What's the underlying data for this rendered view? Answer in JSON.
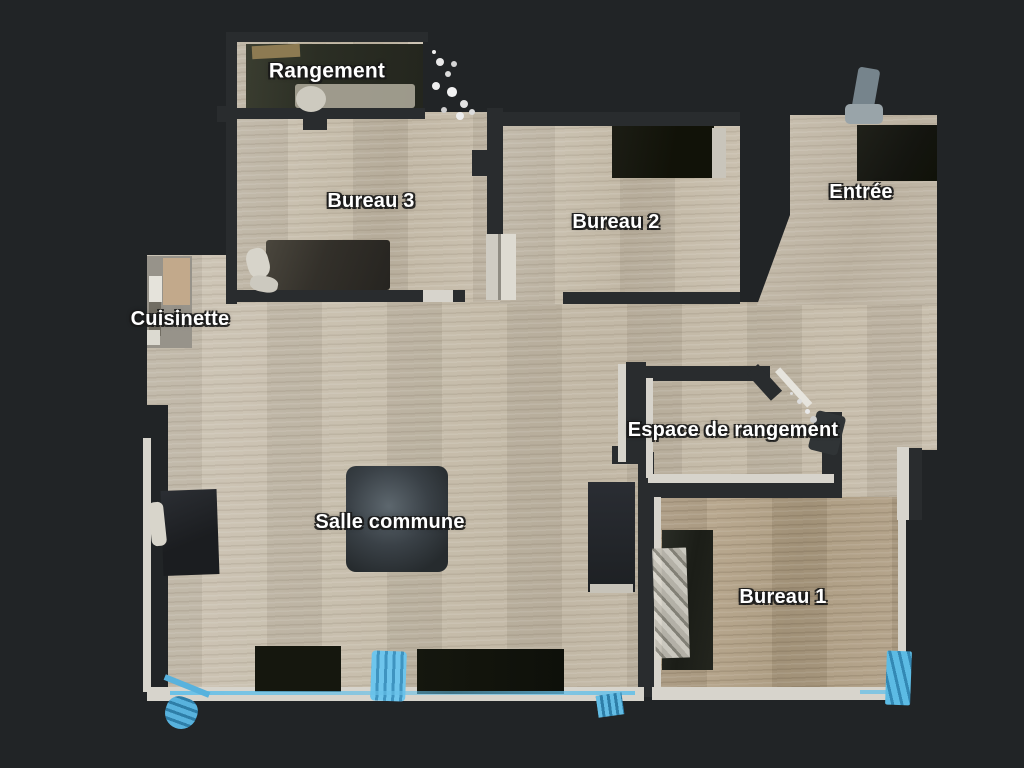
{
  "view": {
    "type": "floor-plan-top-view",
    "background": "#212426"
  },
  "rooms": [
    {
      "id": "rangement",
      "label": "Rangement"
    },
    {
      "id": "bureau-3",
      "label": "Bureau 3"
    },
    {
      "id": "bureau-2",
      "label": "Bureau 2"
    },
    {
      "id": "entree",
      "label": "Entrée"
    },
    {
      "id": "cuisinette",
      "label": "Cuisinette"
    },
    {
      "id": "espace-de-rangement",
      "label": "Espace de rangement"
    },
    {
      "id": "salle-commune",
      "label": "Salle commune"
    },
    {
      "id": "bureau-1",
      "label": "Bureau 1"
    }
  ],
  "colors": {
    "background": "#212426",
    "floor_light": "#c7bdac",
    "floor_dark": "#b4a58e",
    "wall_dark": "#292c2e",
    "wall_light": "#d7d4cc",
    "accent_blue": "#66c0e8",
    "furniture_dark": "#1a1c16",
    "label_text": "#ffffff",
    "label_outline": "#1f1f1f"
  }
}
